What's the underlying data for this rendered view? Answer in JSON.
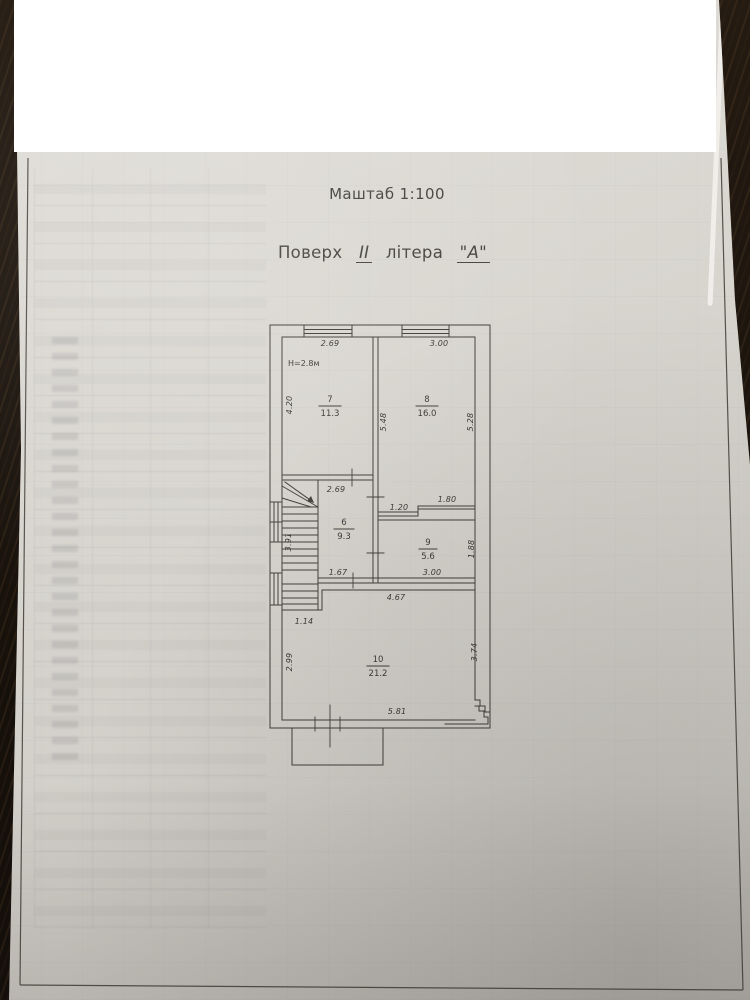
{
  "document": {
    "scale_label": "Маштаб 1:100",
    "floor_prefix": "Поверх",
    "floor_numeral": "II",
    "floor_middle": "літера",
    "floor_letter": "\"А\"",
    "height_note": "Н=2.8м"
  },
  "rooms": [
    {
      "number": "7",
      "area": "11.3"
    },
    {
      "number": "8",
      "area": "16.0"
    },
    {
      "number": "6",
      "area": "9.3"
    },
    {
      "number": "9",
      "area": "5.6"
    },
    {
      "number": "10",
      "area": "21.2"
    }
  ],
  "dimensions": {
    "room7_top": "2.69",
    "room8_top": "3.00",
    "room7_left": "4.20",
    "wall_7_8": "5.48",
    "room8_right": "5.28",
    "room6_top": "2.69",
    "room9_top_left": "1.20",
    "room9_top_right": "1.80",
    "stairs_left": "3.91",
    "room6_bottom": "1.67",
    "room9_right": "1.88",
    "room9_bottom": "3.00",
    "room10_top": "4.67",
    "stair_notch": "1.14",
    "room10_left": "2.99",
    "room10_right": "3.74",
    "room10_bottom": "5.81"
  },
  "colors": {
    "paper": "#d9d6d0",
    "ink": "#403d38",
    "background": "#1a130d",
    "redaction": "#ffffff"
  }
}
